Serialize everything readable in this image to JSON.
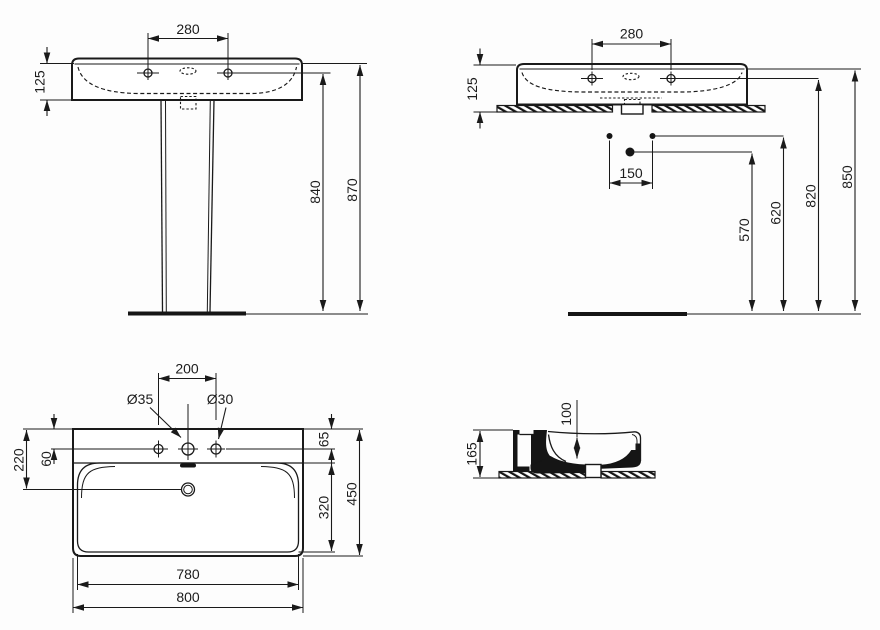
{
  "drawing": {
    "background": "#fdfdfd",
    "line_color": "#1a1a1a",
    "views": {
      "front_pedestal": {
        "tap_spacing": "280",
        "front_height": "125",
        "height_to_tap_line": "840",
        "overall_height": "870"
      },
      "front_wall_hung": {
        "tap_spacing": "280",
        "front_height": "125",
        "fixing_spacing": "150",
        "drain_height": "570",
        "fixing_height": "620",
        "tap_line_height": "820",
        "rim_height": "850"
      },
      "plan": {
        "tap_spacing": "200",
        "center_hole_dia": "Ø35",
        "side_hole_dia": "Ø30",
        "drain_setback": "220",
        "tap_setback": "60",
        "back_ledge": "65",
        "bowl_depth": "320",
        "overall_depth": "450",
        "bowl_width": "780",
        "overall_width": "800"
      },
      "section": {
        "overall_height": "165",
        "bowl_inner_depth": "100"
      }
    }
  }
}
